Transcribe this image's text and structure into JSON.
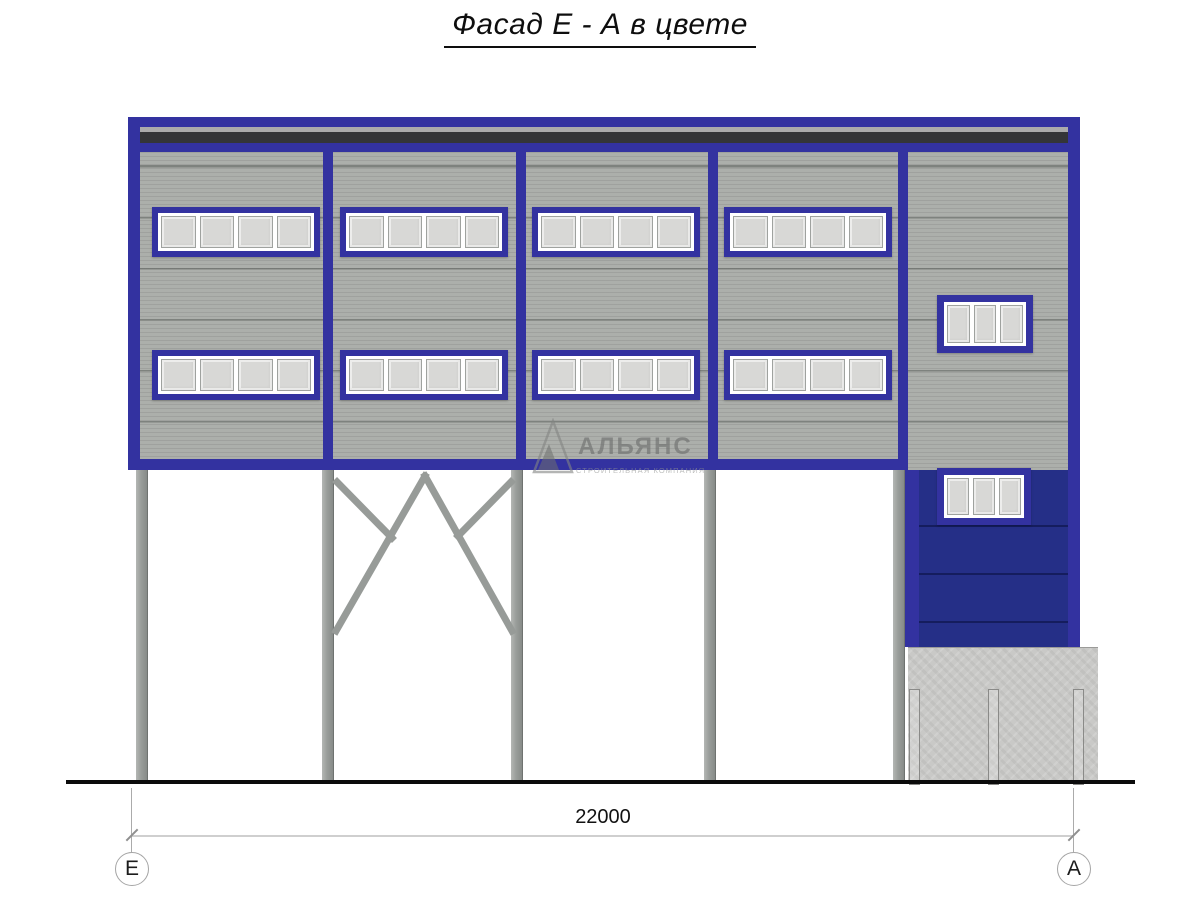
{
  "title": "Фасад Е - А в цвете",
  "dimension": {
    "total_length": "22000"
  },
  "axes": {
    "left": "Е",
    "right": "А"
  },
  "watermark": {
    "name": "АЛЬЯНС",
    "subtitle": "СТРОИТЕЛЬНАЯ КОМПАНИЯ"
  },
  "drawing": {
    "bays": 5,
    "ribbon_windows": 8,
    "ribbon_window_panes": 4,
    "small_windows": 2,
    "small_window_panes": 3,
    "columns": 5
  },
  "colors": {
    "frame-blue": "#3332A0",
    "panel-blue": "#252F87",
    "wall-gray": "#ACAFAB",
    "roof-dark": "#343537",
    "roof-light": "#ABABAB",
    "column-gray": "#9A9E9B",
    "concrete": "#C9C9C7",
    "glass": "#D8D8D6",
    "ground": "#0B0B0B"
  }
}
